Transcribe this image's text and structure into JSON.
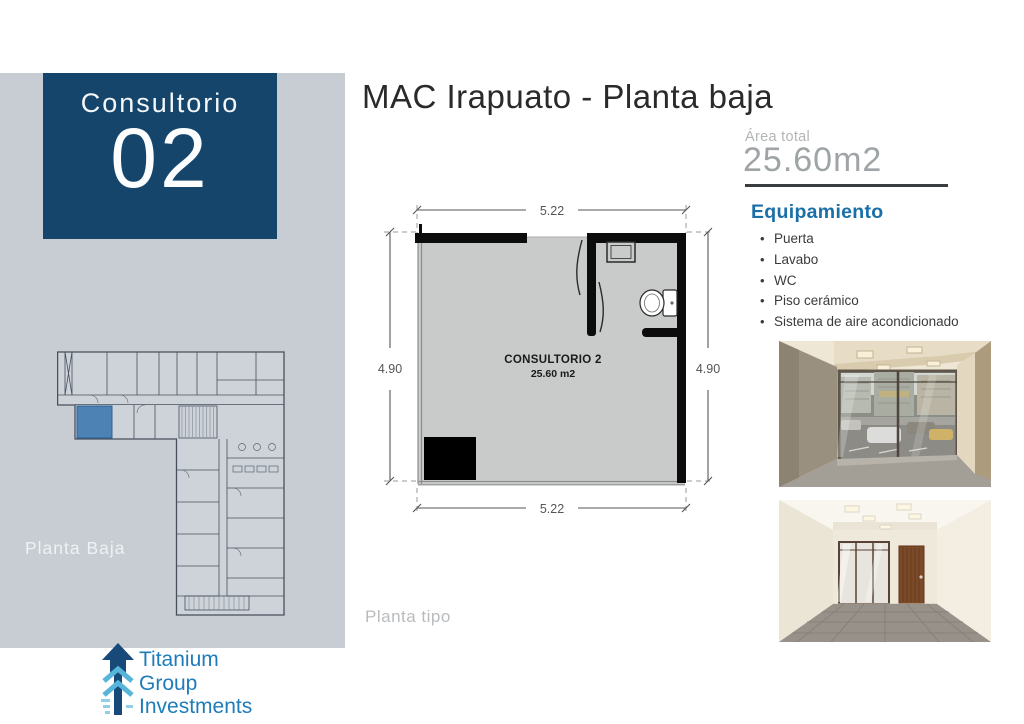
{
  "slide": {
    "title": "MAC Irapuato - Planta baja",
    "unit_label": "Consultorio",
    "unit_number": "02",
    "floor_label": "Planta Baja",
    "plan_type_label": "Planta tipo"
  },
  "area": {
    "label": "Área total",
    "value": "25.60m2"
  },
  "equipment": {
    "heading": "Equipamiento",
    "items": [
      "Puerta",
      "Lavabo",
      "WC",
      "Piso cerámico",
      "Sistema de aire acondicionado"
    ]
  },
  "floor_plan": {
    "room_name": "CONSULTORIO 2",
    "room_area": "25.60 m2",
    "dim_width_top": "5.22",
    "dim_width_bottom": "5.22",
    "dim_height_left": "4.90",
    "dim_height_right": "4.90"
  },
  "logo": {
    "lines": [
      "Titanium",
      "Group",
      "Investments"
    ]
  },
  "colors": {
    "panel_navy": "#16456b",
    "sidebar_gray": "#c8cdd3",
    "accent_blue": "#1a6fa8",
    "logo_blue": "#1e7cba",
    "highlight_room_blue": "#4d82b5",
    "plan_room_fill": "#c9cbca"
  }
}
